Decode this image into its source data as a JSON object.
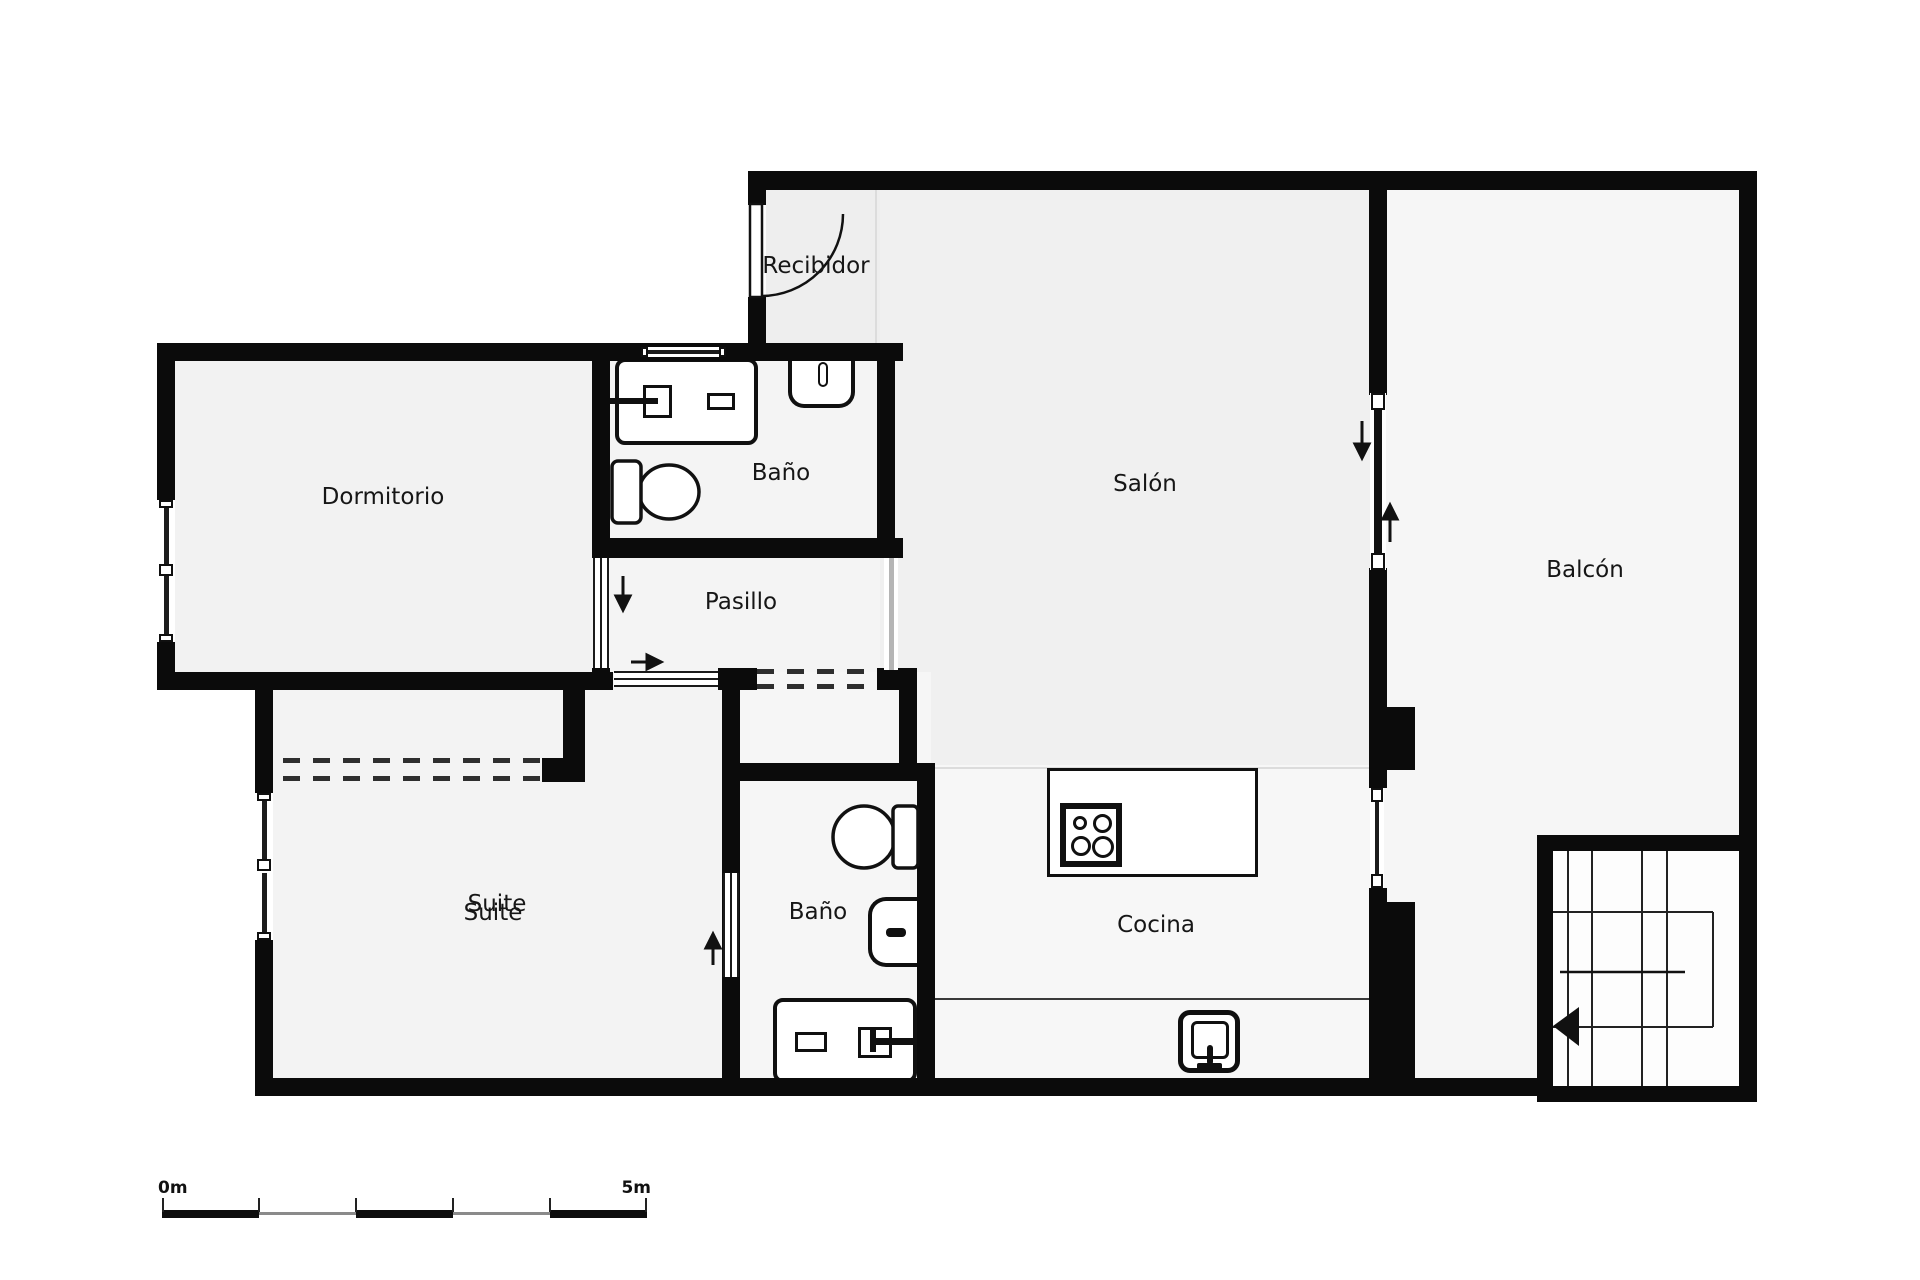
{
  "rooms": {
    "recibidor": "Recibidor",
    "dormitorio": "Dormitorio",
    "bano_top": "Baño",
    "pasillo": "Pasillo",
    "salon": "Salón",
    "balcon": "Balcón",
    "suite": "Suite",
    "bano_bottom": "Baño",
    "cocina": "Cocina"
  },
  "scale": {
    "zero": "0m",
    "five": "5m",
    "segments": 5
  },
  "colors": {
    "wall": "#0b0b0b",
    "floor_salon": "#f0f0f0",
    "floor_cocina": "#f7f7f7",
    "scale_dark": "#0d0d0d",
    "scale_gray": "#8a8a8a"
  },
  "fixtures": [
    "entry-door-swing",
    "bathroom-window",
    "vanity-sink-top",
    "wall-toilet-top",
    "toilet-top-bath",
    "sliding-door-dormitorio",
    "sliding-door-pasillo-suite",
    "sliding-door-suite-bath",
    "wardrobe-dashed-opening",
    "pasillo-dashed-opening",
    "toilet-bottom-bath",
    "washbasin-bottom-bath",
    "vanity-sink-bottom",
    "kitchen-island",
    "stove-4-burners",
    "kitchen-sink-appliance",
    "balcony-sliding-door",
    "balcony-small-window",
    "staircase-with-arrow",
    "window-dormitorio",
    "window-suite"
  ],
  "arrows": [
    "down-pasillo",
    "right-pasillo",
    "up-suite-bath",
    "down-salon-balcony",
    "up-balcony",
    "left-stairs"
  ]
}
